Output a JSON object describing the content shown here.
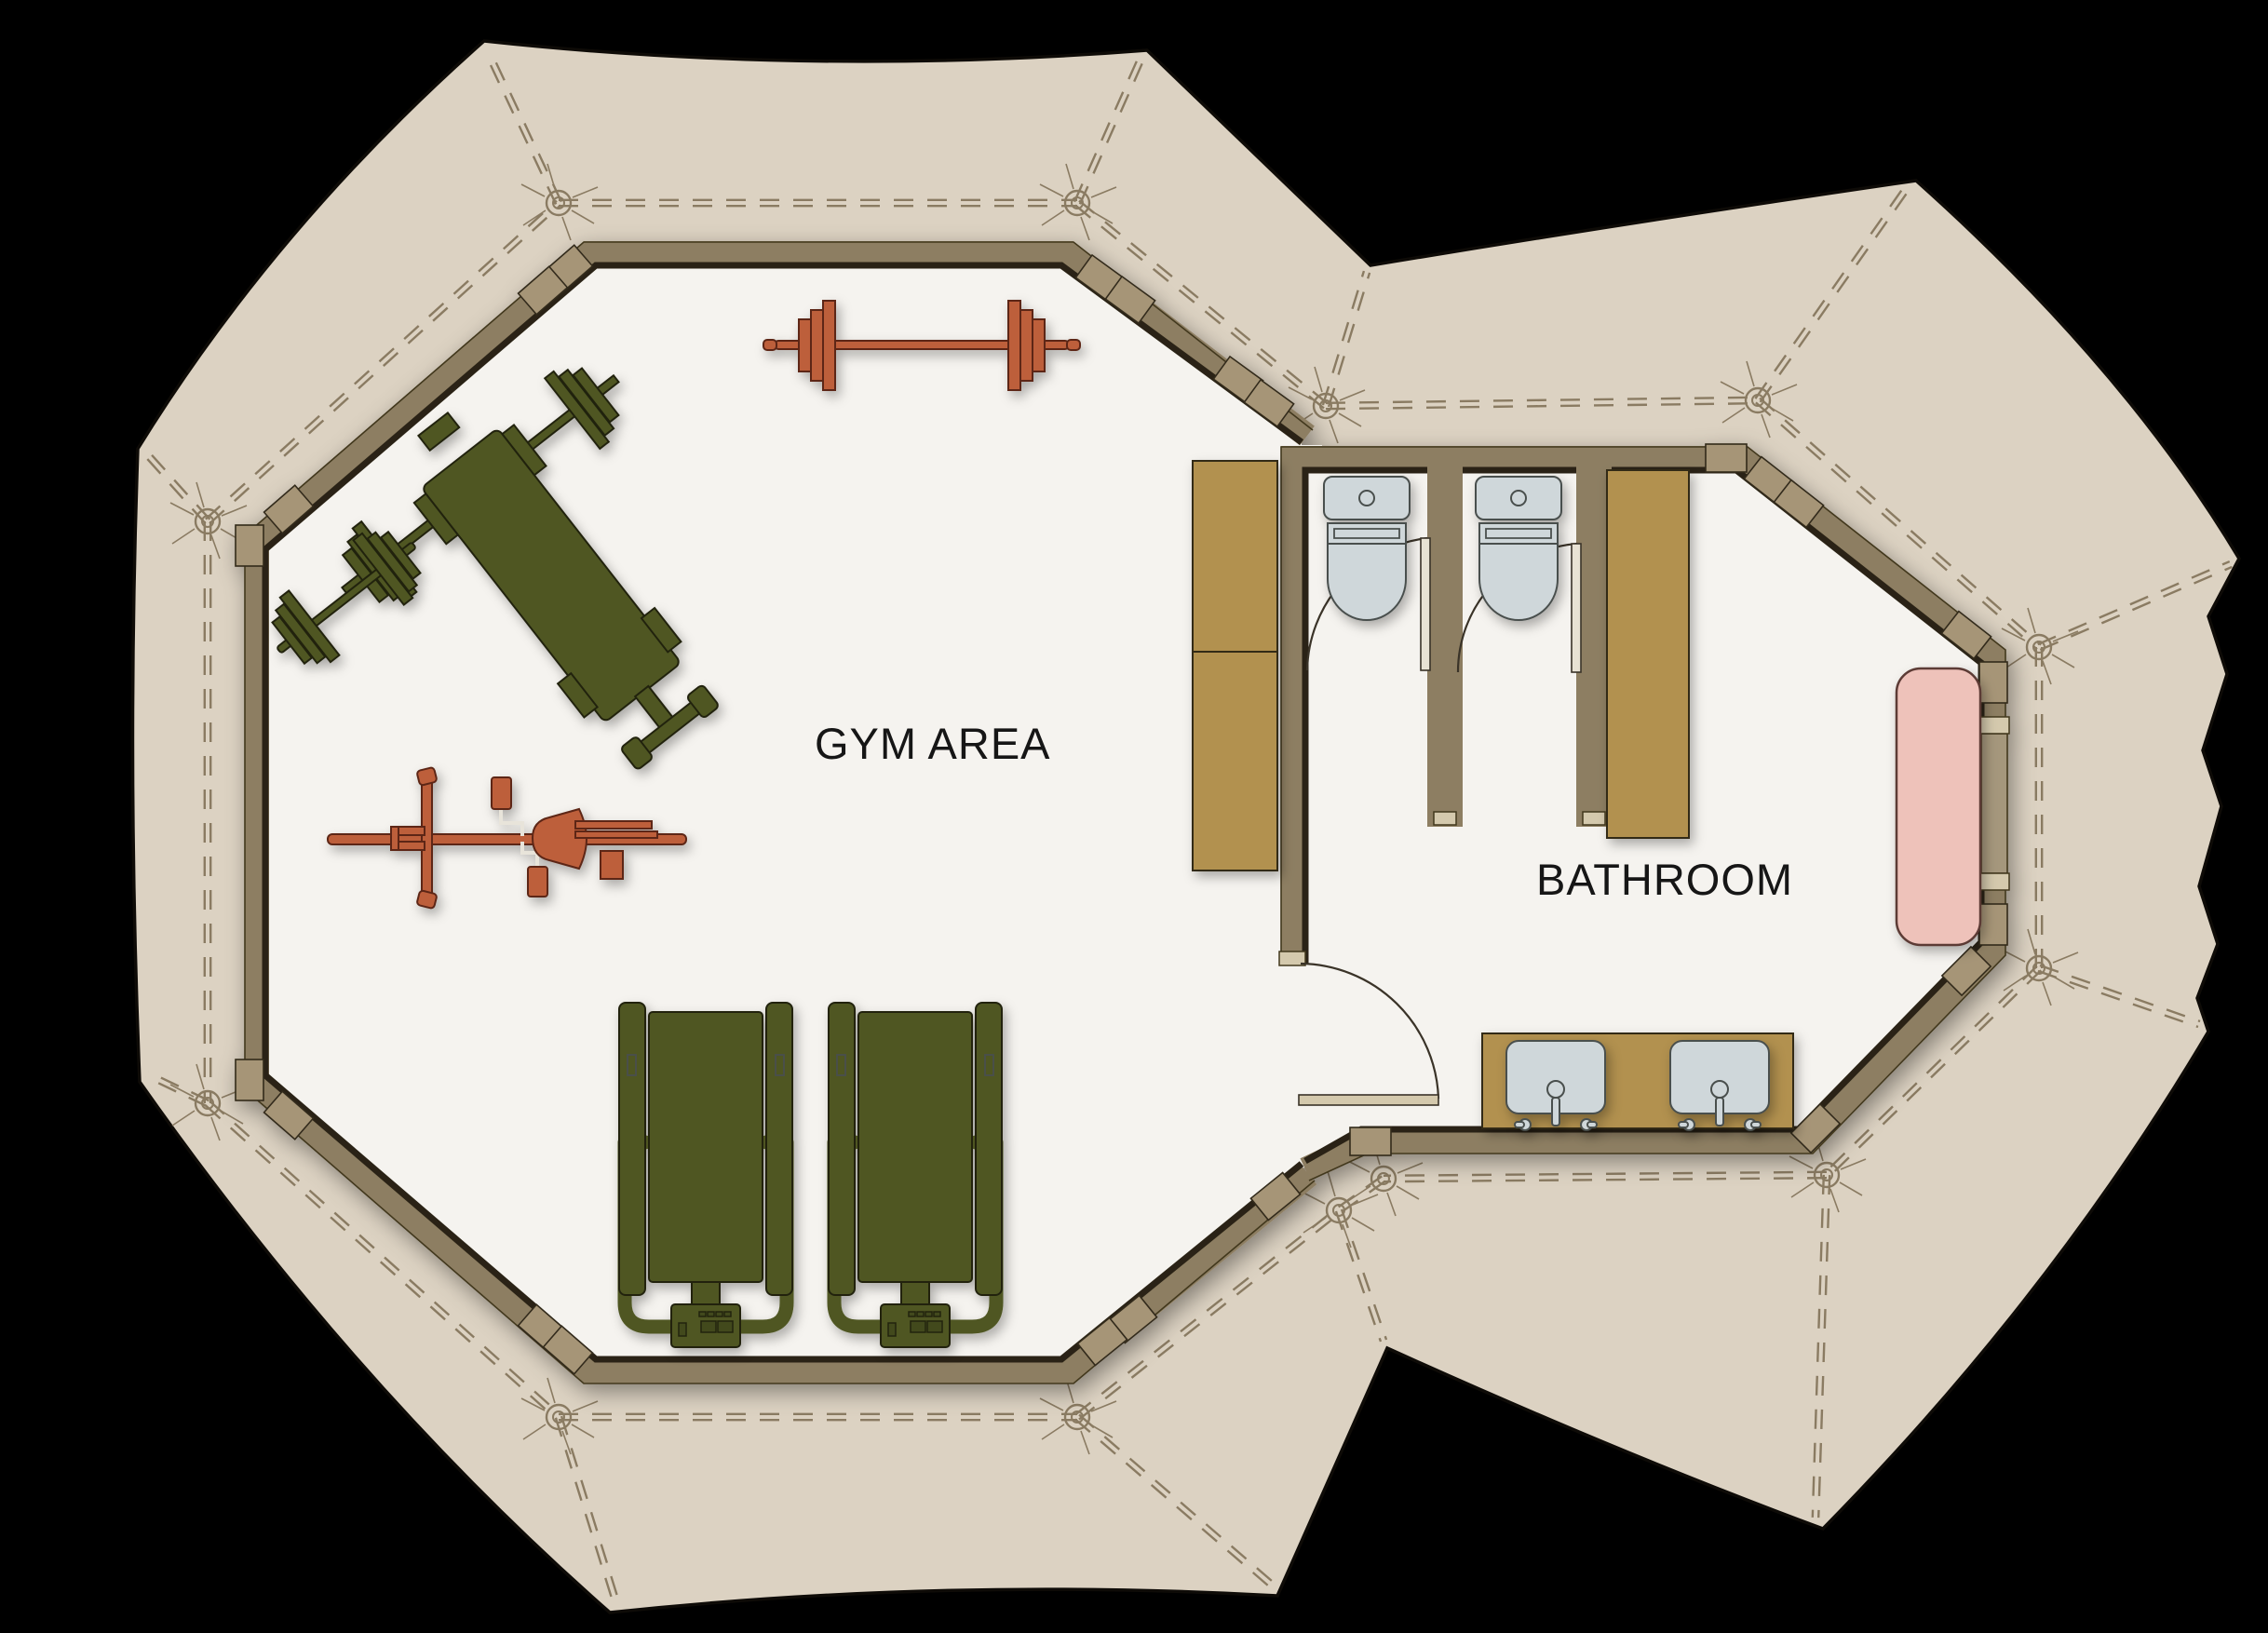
{
  "page": {
    "type": "architectural-floor-plan",
    "background": "#000000"
  },
  "rooms": [
    {
      "id": "gym",
      "label": "GYM AREA"
    },
    {
      "id": "bathroom",
      "label": "BATHROOM"
    }
  ],
  "fixtures": {
    "gym": [
      "barbell",
      "weight-bench-with-barbell",
      "dumbbell",
      "exercise-bike",
      "treadmill",
      "treadmill",
      "storage-cabinet"
    ],
    "bathroom": [
      "toilet",
      "toilet",
      "stall-door",
      "stall-door",
      "storage-cabinet",
      "bench-seat",
      "double-sink-vanity",
      "entry-door",
      "side-door"
    ]
  },
  "structure": {
    "tents": 2,
    "shape": "octagonal canvas tents with grommets and seam lines"
  },
  "colors": {
    "background": "#000000",
    "canvas": "#dcd2c2",
    "floor": "#f5f3ef",
    "wall": "#8d7e62",
    "wall_outline": "#2b2413",
    "corner_block": "#a69577",
    "cabinet": "#b2914f",
    "fixture": "#cfd7da",
    "pink_bench": "#eec2ba",
    "equipment_green": "#4f5724",
    "equipment_rust": "#bd5e3b",
    "door_leaf": "#d4c9ad",
    "seam": "#8a7b62",
    "label_text": "#161616"
  }
}
